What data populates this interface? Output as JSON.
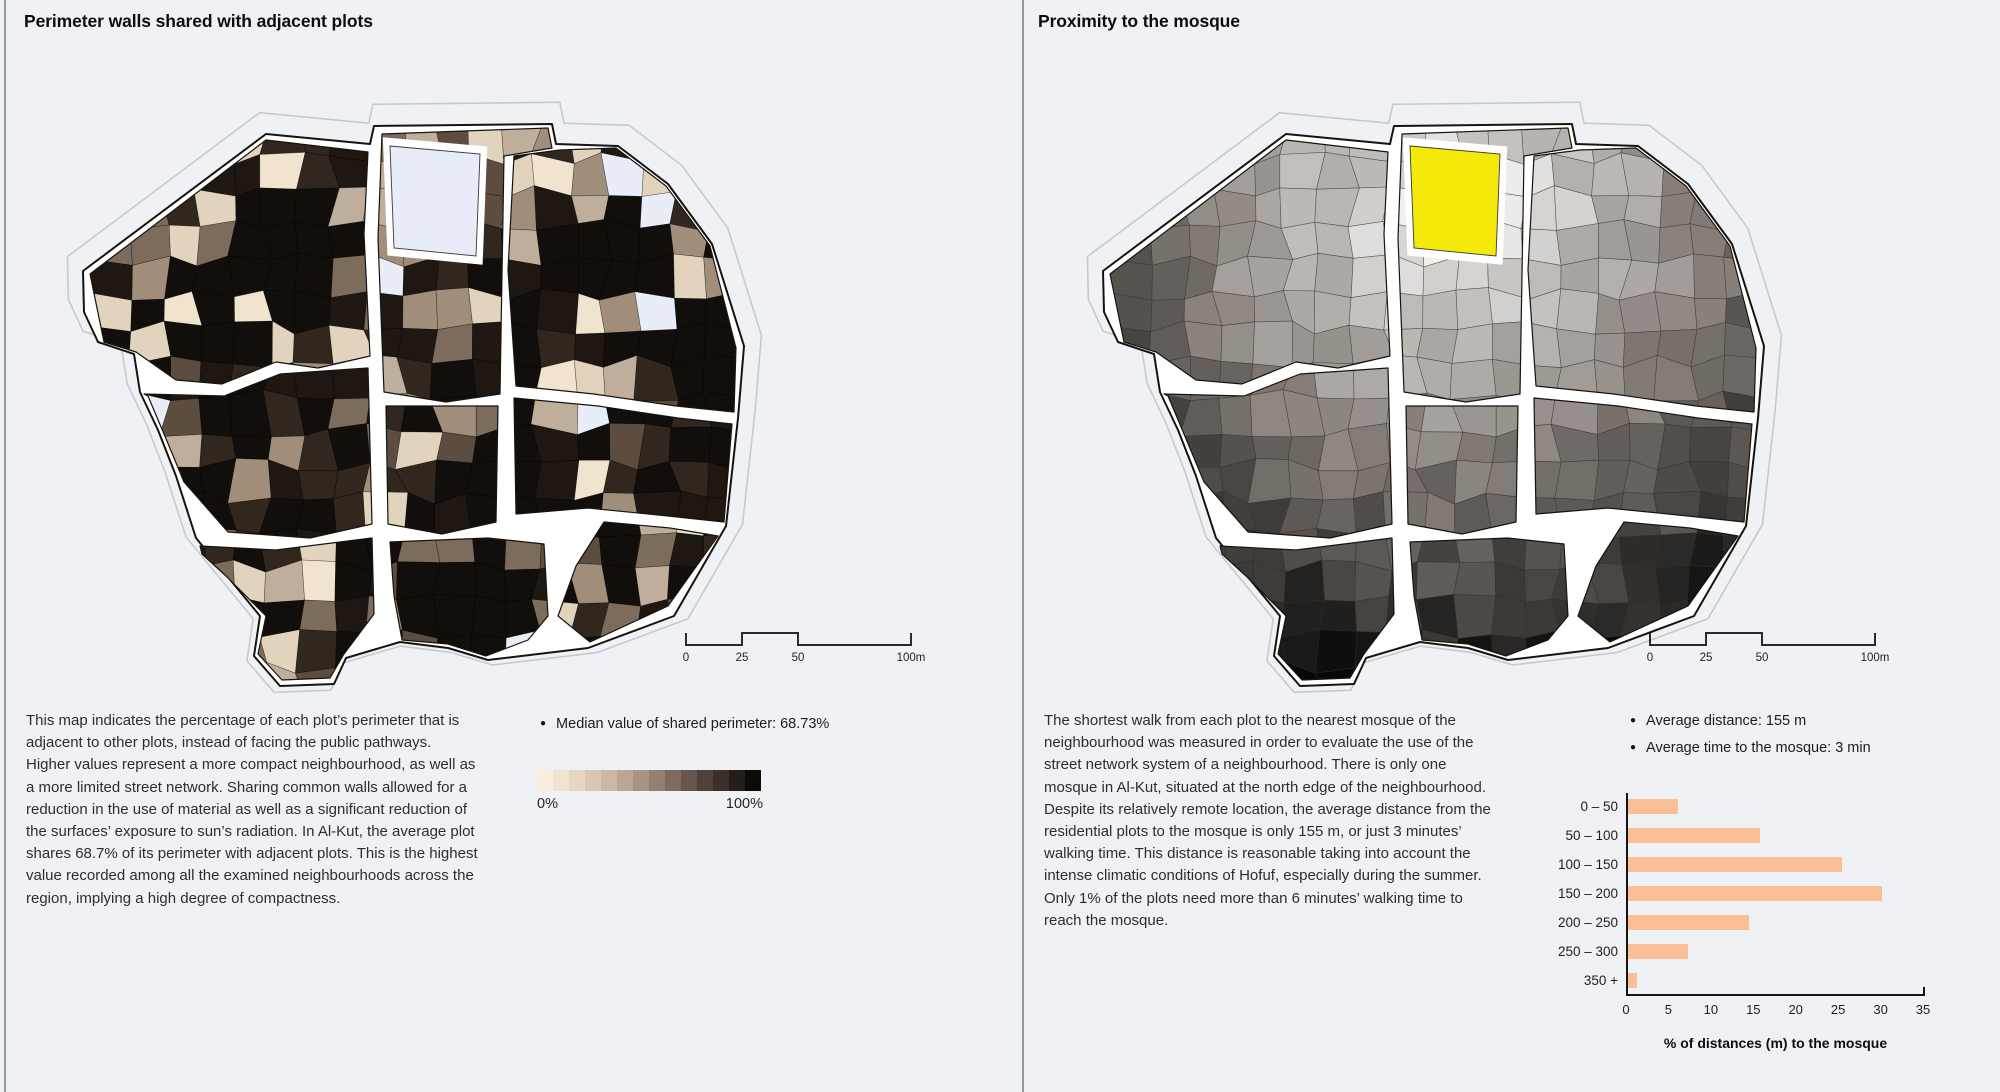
{
  "page": {
    "background": "#eff1f4",
    "divider_color": "#96999e"
  },
  "left_panel": {
    "title": "Perimeter walls shared with adjacent plots",
    "description": "This map indicates the percentage of each plot’s perimeter that is adjacent to other plots, instead of facing the public pathways. Higher values represent a more compact neighbourhood, as well as a more limited street network. Sharing common walls allowed for a reduction in the use of material as well as a significant reduction of the surfaces’ exposure to sun’s radiation. In Al-Kut, the average plot shares 68.7% of its perimeter with adjacent plots. This is the highest value recorded among all the examined neighbourhoods across the region, implying a high degree of compactness.",
    "legend": {
      "median_label": "Median value of shared perimeter: 68.73%",
      "min_label": "0%",
      "max_label": "100%",
      "gradient_steps": [
        "#f7eedf",
        "#f0e3d2",
        "#e6d6c2",
        "#dac7b2",
        "#ccb7a3",
        "#bba695",
        "#a89384",
        "#948072",
        "#7e6b60",
        "#67564d",
        "#50423b",
        "#3a2f29",
        "#251d18",
        "#0e0a07"
      ]
    },
    "scale_bar": {
      "labels": [
        "0",
        "25",
        "50",
        "100m"
      ]
    }
  },
  "right_panel": {
    "title": "Proximity to the mosque",
    "description": "The shortest walk from each plot to the nearest mosque of the neighbourhood was measured in order to evaluate the use of the street network system of a neighbourhood. There is only one mosque in Al-Kut, situated at the north edge of the neighbourhood. Despite its relatively remote location, the average distance from the residential plots to the mosque is only 155 m, or just 3 minutes’ walking time. This distance is reasonable taking into account the intense climatic conditions of Hofuf, especially during the summer. Only 1% of the plots need more than 6 minutes’ walking time to reach the mosque.",
    "legend": {
      "items": [
        "Average distance: 155 m",
        "Average time to the mosque: 3 min"
      ]
    },
    "scale_bar": {
      "labels": [
        "0",
        "25",
        "50",
        "100m"
      ]
    },
    "chart_data": {
      "type": "bar",
      "orientation": "horizontal",
      "categories": [
        "0 – 50",
        "50 – 100",
        "100 – 150",
        "150 – 200",
        "200 – 250",
        "250 – 300",
        "350 +"
      ],
      "values": [
        6,
        15.7,
        25.3,
        30,
        14.4,
        7.2,
        1.2
      ],
      "xticks": [
        0,
        5,
        10,
        15,
        20,
        25,
        30,
        35
      ],
      "xlim": [
        0,
        35
      ],
      "xlabel": "% of distances (m) to the mosque",
      "bar_color": "#fbbf98",
      "grid": false,
      "legend_position": "none"
    }
  },
  "map": {
    "colors": {
      "street": "#ffffff",
      "outline": "#17130f",
      "contour": "#c6cad0",
      "mosque_left": "#e7ecf8",
      "mosque_right": "#f5e90a",
      "plot_stroke_left": "rgba(0,0,0,0.45)",
      "plot_stroke_right": "rgba(50,46,42,0.65)",
      "left_base": "#14100c"
    },
    "left_palette": [
      [
        "#120e0b",
        0.4
      ],
      [
        "#1e1712",
        0.13
      ],
      [
        "#31271e",
        0.09
      ],
      [
        "#5c4d40",
        0.06
      ],
      [
        "#7d6c5c",
        0.07
      ],
      [
        "#a08d7a",
        0.07
      ],
      [
        "#bfae9b",
        0.06
      ],
      [
        "#e2d3bd",
        0.05
      ],
      [
        "#f1e4cf",
        0.04
      ],
      [
        "#e8edf8",
        0.03
      ]
    ],
    "silhouette": [
      [
        55,
        215
      ],
      [
        238,
        78
      ],
      [
        342,
        88
      ],
      [
        346,
        70
      ],
      [
        524,
        68
      ],
      [
        528,
        88
      ],
      [
        590,
        90
      ],
      [
        640,
        128
      ],
      [
        684,
        188
      ],
      [
        716,
        290
      ],
      [
        710,
        362
      ],
      [
        698,
        470
      ],
      [
        646,
        560
      ],
      [
        560,
        592
      ],
      [
        460,
        604
      ],
      [
        420,
        592
      ],
      [
        372,
        586
      ],
      [
        318,
        602
      ],
      [
        306,
        628
      ],
      [
        252,
        630
      ],
      [
        226,
        600
      ],
      [
        232,
        560
      ],
      [
        168,
        482
      ],
      [
        148,
        420
      ],
      [
        130,
        374
      ],
      [
        112,
        336
      ],
      [
        106,
        298
      ],
      [
        70,
        286
      ],
      [
        56,
        256
      ]
    ],
    "blocks": [
      [
        [
          62,
          218
        ],
        [
          238,
          84
        ],
        [
          340,
          96
        ],
        [
          336,
          178
        ],
        [
          342,
          300
        ],
        [
          290,
          312
        ],
        [
          248,
          306
        ],
        [
          194,
          328
        ],
        [
          148,
          324
        ],
        [
          108,
          296
        ],
        [
          76,
          286
        ]
      ],
      [
        [
          354,
          78
        ],
        [
          520,
          72
        ],
        [
          524,
          92
        ],
        [
          476,
          100
        ],
        [
          472,
          338
        ],
        [
          418,
          346
        ],
        [
          356,
          336
        ],
        [
          350,
          182
        ]
      ],
      [
        [
          486,
          100
        ],
        [
          532,
          94
        ],
        [
          588,
          92
        ],
        [
          638,
          130
        ],
        [
          682,
          190
        ],
        [
          708,
          292
        ],
        [
          706,
          356
        ],
        [
          648,
          350
        ],
        [
          566,
          338
        ],
        [
          488,
          330
        ],
        [
          480,
          214
        ]
      ],
      [
        [
          116,
          338
        ],
        [
          196,
          340
        ],
        [
          252,
          318
        ],
        [
          340,
          312
        ],
        [
          344,
          468
        ],
        [
          282,
          482
        ],
        [
          200,
          476
        ],
        [
          156,
          426
        ],
        [
          136,
          378
        ],
        [
          120,
          340
        ]
      ],
      [
        [
          358,
          350
        ],
        [
          470,
          350
        ],
        [
          468,
          466
        ],
        [
          414,
          478
        ],
        [
          360,
          468
        ]
      ],
      [
        [
          486,
          342
        ],
        [
          570,
          350
        ],
        [
          650,
          362
        ],
        [
          704,
          368
        ],
        [
          696,
          466
        ],
        [
          640,
          460
        ],
        [
          560,
          452
        ],
        [
          488,
          458
        ]
      ],
      [
        [
          172,
          490
        ],
        [
          248,
          494
        ],
        [
          344,
          482
        ],
        [
          346,
          558
        ],
        [
          316,
          598
        ],
        [
          302,
          622
        ],
        [
          254,
          624
        ],
        [
          230,
          598
        ],
        [
          238,
          560
        ],
        [
          198,
          520
        ],
        [
          174,
          498
        ]
      ],
      [
        [
          362,
          486
        ],
        [
          460,
          482
        ],
        [
          516,
          488
        ],
        [
          520,
          560
        ],
        [
          500,
          584
        ],
        [
          458,
          600
        ],
        [
          420,
          588
        ],
        [
          374,
          584
        ],
        [
          366,
          540
        ]
      ],
      [
        [
          576,
          466
        ],
        [
          642,
          472
        ],
        [
          690,
          480
        ],
        [
          640,
          550
        ],
        [
          562,
          586
        ],
        [
          530,
          560
        ],
        [
          548,
          510
        ]
      ]
    ],
    "mosque": [
      [
        362,
        90
      ],
      [
        452,
        98
      ],
      [
        448,
        200
      ],
      [
        366,
        192
      ]
    ],
    "mosque_center": [
      405,
      150
    ],
    "cell": 34,
    "jitter": 14
  }
}
